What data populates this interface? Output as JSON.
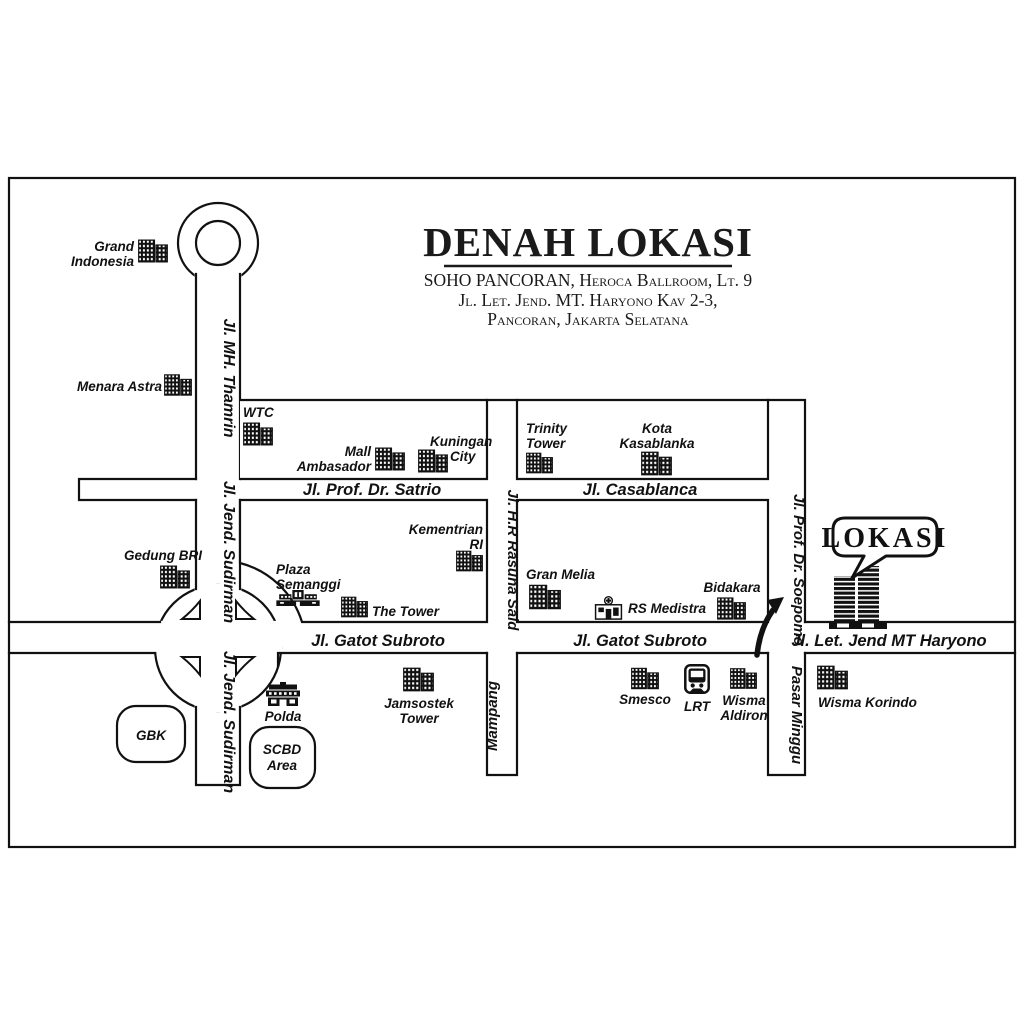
{
  "header": {
    "title": "DENAH LOKASI",
    "subtitle_line1": "SOHO PANCORAN, Heroca Ballroom, Lt. 9",
    "subtitle_line2": "Jl. Let. Jend. MT. Haryono Kav 2-3,",
    "subtitle_line3": "Pancoran, Jakarta Selatana"
  },
  "roads": {
    "satrio": "Jl. Prof. Dr. Satrio",
    "casablanca": "Jl. Casablanca",
    "gatot_subroto_west": "Jl. Gatot Subroto",
    "gatot_subroto_east": "Jl. Gatot Subroto",
    "mt_haryono": "Jl. Let. Jend MT Haryono",
    "thamrin": "Jl. MH. Thamrin",
    "sudirman_upper": "Jl. Jend. Sudirman",
    "sudirman_lower": "Jl. Jend. Sudirman",
    "rasuna_said": "Jl. H.R Rasuna Said",
    "mampang": "Mampang",
    "soepomo": "Jl. Prof. Dr. Soepomo",
    "pasar_minggu": "Pasar Minggu"
  },
  "places": {
    "grand_indonesia": {
      "line1": "Grand",
      "line2": "Indonesia"
    },
    "menara_astra": {
      "line1": "Menara Astra"
    },
    "wtc": {
      "line1": "WTC"
    },
    "mall_ambasador": {
      "line1": "Mall",
      "line2": "Ambasador"
    },
    "kuningan_city": {
      "line1": "Kuningan",
      "line2": "City"
    },
    "trinity_tower": {
      "line1": "Trinity",
      "line2": "Tower"
    },
    "kota_kasablanka": {
      "line1": "Kota",
      "line2": "Kasablanka"
    },
    "gedung_bri": {
      "line1": "Gedung BRI"
    },
    "plaza_semanggi": {
      "line1": "Plaza",
      "line2": "Semanggi"
    },
    "the_tower": {
      "line1": "The Tower"
    },
    "kementrian_ri": {
      "line1": "Kementrian",
      "line2": "RI"
    },
    "gran_melia": {
      "line1": "Gran Melia"
    },
    "rs_medistra": {
      "line1": "RS Medistra"
    },
    "bidakara": {
      "line1": "Bidakara"
    },
    "polda": {
      "line1": "Polda"
    },
    "gbk": {
      "line1": "GBK"
    },
    "scbd_area": {
      "line1": "SCBD",
      "line2": "Area"
    },
    "jamsostek_tower": {
      "line1": "Jamsostek",
      "line2": "Tower"
    },
    "smesco": {
      "line1": "Smesco"
    },
    "lrt": {
      "line1": "LRT"
    },
    "wisma_aldiron": {
      "line1": "Wisma",
      "line2": "Aldiron"
    },
    "wisma_korindo": {
      "line1": "Wisma Korindo"
    }
  },
  "callout": {
    "label": "LOKASI"
  },
  "colors": {
    "ink": "#111111",
    "paper": "#ffffff"
  }
}
